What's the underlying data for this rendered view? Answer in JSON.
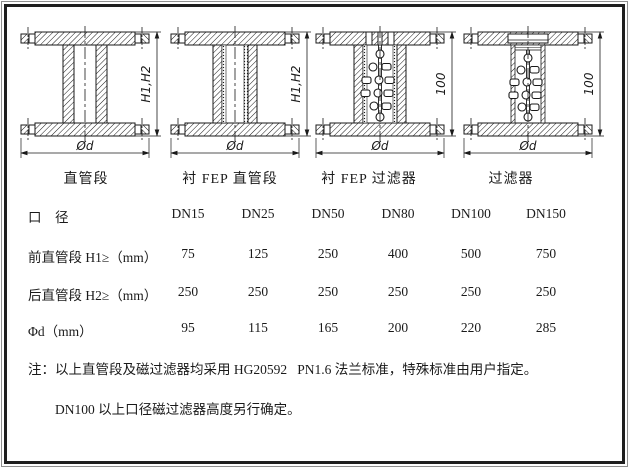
{
  "page": {
    "background": "#ffffff",
    "ink": "#1a1a1a",
    "frame_color": "#1f1f1f"
  },
  "diagrams": [
    {
      "caption": "直管段",
      "v_dim": "H1,H2",
      "h_dim": "Ød"
    },
    {
      "caption": "衬 FEP 直管段",
      "v_dim": "H1,H2",
      "h_dim": "Ød"
    },
    {
      "caption": "衬 FEP 过滤器",
      "v_dim": "100",
      "h_dim": "Ød"
    },
    {
      "caption": "过滤器",
      "v_dim": "100",
      "h_dim": "Ød"
    }
  ],
  "table": {
    "header_label": "口　径",
    "columns": [
      "DN15",
      "DN25",
      "DN50",
      "DN80",
      "DN100",
      "DN150"
    ],
    "rows": [
      {
        "label": "前直管段 H1≥（mm）",
        "values": [
          "75",
          "125",
          "250",
          "400",
          "500",
          "750"
        ]
      },
      {
        "label": "后直管段 H2≥（mm）",
        "values": [
          "250",
          "250",
          "250",
          "250",
          "250",
          "250"
        ]
      },
      {
        "label": "Φd（mm）",
        "values": [
          "95",
          "115",
          "165",
          "200",
          "220",
          "285"
        ]
      }
    ]
  },
  "notes": [
    "注：以上直管段及磁过滤器均采用 HG20592   PN1.6 法兰标准，特殊标准由用户指定。",
    "DN100 以上口径磁过滤器高度另行确定。"
  ]
}
